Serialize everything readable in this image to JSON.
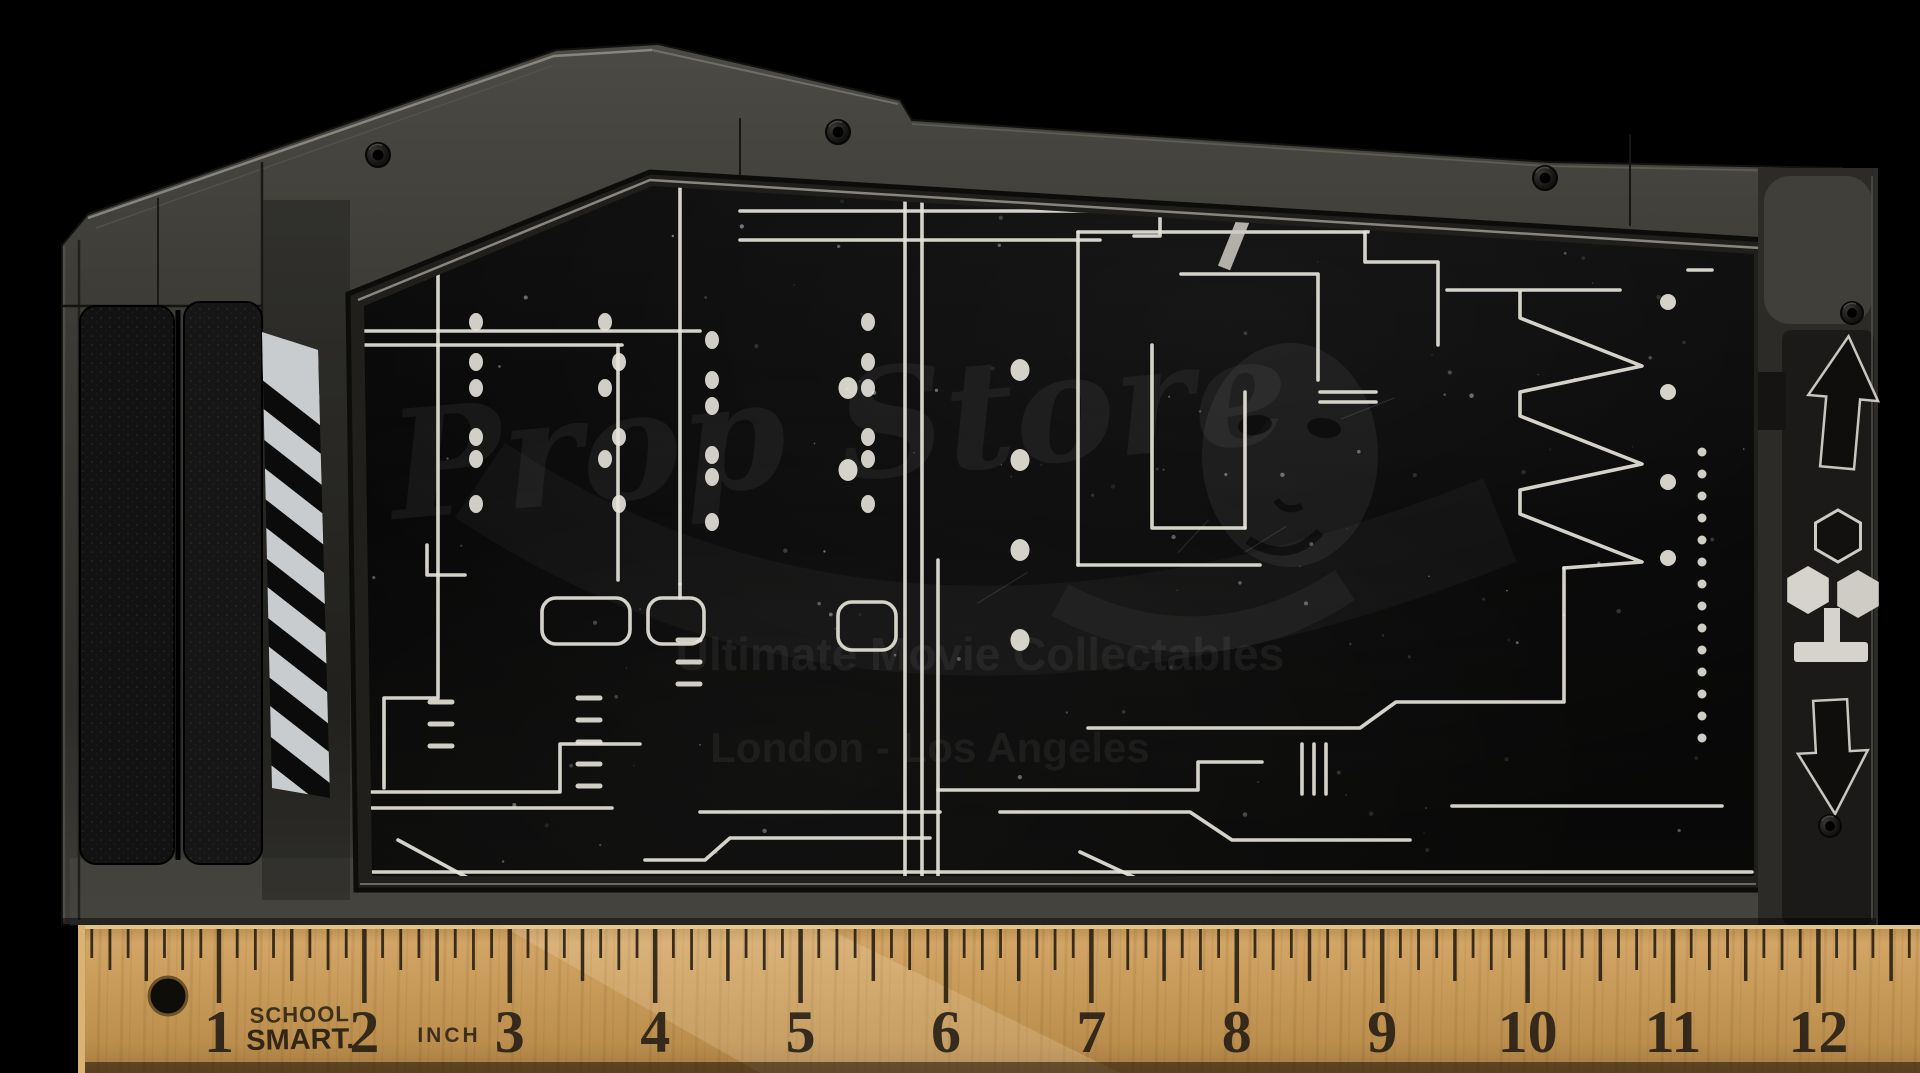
{
  "scene": {
    "background": "#000000",
    "description": "Sci-fi movie prop electronic panel with etched circuit screen, photographed above a wooden school ruler on black"
  },
  "watermark": {
    "script_text": "Prop Store",
    "line1": "Ultimate Movie Collectables",
    "line2": "London - Los Angeles",
    "mask_icon": "comedy-mask-icon",
    "color": "#ffffff"
  },
  "prop": {
    "body_color": "#3b3a36",
    "panel_color": "#2c2b28",
    "screen_color": "#060606",
    "trace_color": "#e6e3da",
    "grip": {
      "name": "leather-grip",
      "strips": 2,
      "color": "#121212"
    },
    "hazard_stripes": {
      "stripe_color": "#c9ccce",
      "gap_color": "#0b0b0b"
    },
    "icons": [
      {
        "name": "up-arrow-icon"
      },
      {
        "name": "hex-molecule-icon"
      },
      {
        "name": "down-arrow-icon"
      }
    ],
    "screws": [
      {
        "x": 378,
        "y": 155,
        "r": 12
      },
      {
        "x": 838,
        "y": 132,
        "r": 12
      },
      {
        "x": 1545,
        "y": 178,
        "r": 12
      },
      {
        "x": 1852,
        "y": 313,
        "r": 11
      },
      {
        "x": 1830,
        "y": 826,
        "r": 11
      }
    ],
    "traces": [
      "455,172 455,230 432,230 432,258",
      "352,249 480,249",
      "438,255 438,698 384,698 384,788",
      "352,331 700,331",
      "352,345 622,345",
      "520,160 662,160",
      "680,148 680,584",
      "618,345 618,580",
      "680,584 680,598",
      "427,545 427,575 465,575",
      "352,792 558,792",
      "352,808 612,808",
      "398,840 468,878",
      "468,878 648,878",
      "560,792 560,744 640,744",
      "905,150 905,878",
      "922,150 922,878",
      "938,560 938,878",
      "770,188 905,188",
      "740,211 1160,211 1160,236 1134,236",
      "740,240 1100,240",
      "1181,274 1318,274 1318,380",
      "1320,392 1376,392",
      "1320,402 1376,402",
      "938,790 1198,790 1198,762 1262,762",
      "1000,812 1190,812 1232,840 1410,840",
      "1452,806 1722,806",
      "1302,744 1302,794",
      "1314,744 1314,794",
      "1326,744 1326,794",
      "1080,852 1140,880",
      "1564,568 1564,702 1396,702 1360,728 1088,728",
      "1078,232 1365,232",
      "1078,232 1078,565",
      "1078,565 1260,565",
      "1368,168 1368,232",
      "1365,232 1365,262 1438,262 1438,345",
      "1152,345 1152,528 1245,528",
      "1245,392 1245,528",
      "1447,290 1620,290",
      "1688,270 1712,270",
      "1520,292 1520,318 1642,366 1520,392 1520,416 1642,464 1520,490 1520,514 1642,562 1564,568",
      "700,812 940,812",
      "645,860 705,860 730,838 930,838",
      "364,872 1752,872"
    ],
    "diagonal_trace": {
      "x1": 1253,
      "y1": 196,
      "x2": 1224,
      "y2": 268,
      "width": 13
    },
    "rounded_boxes": [
      [
        542,
        598,
        88,
        46
      ],
      [
        648,
        598,
        56,
        46
      ],
      [
        838,
        602,
        58,
        48
      ]
    ],
    "dashes": [
      [
        430,
        702
      ],
      [
        430,
        724
      ],
      [
        430,
        746
      ],
      [
        578,
        698
      ],
      [
        578,
        720
      ],
      [
        578,
        742
      ],
      [
        578,
        764
      ],
      [
        578,
        786
      ],
      [
        678,
        640
      ],
      [
        678,
        662
      ],
      [
        678,
        684
      ]
    ],
    "dot_columns": [
      {
        "x": 476,
        "ys": [
          322,
          362,
          388,
          437,
          459,
          504
        ]
      },
      {
        "x": 612,
        "ys": [
          322,
          362,
          388,
          437,
          459,
          504
        ],
        "stagger": 7
      },
      {
        "x": 712,
        "ys": [
          340,
          380,
          406,
          455,
          477,
          522
        ]
      },
      {
        "x": 868,
        "ys": [
          322,
          362,
          388,
          437,
          459,
          504
        ]
      }
    ],
    "big_dots": [
      [
        848,
        388
      ],
      [
        848,
        470
      ],
      [
        1020,
        370
      ],
      [
        1020,
        460
      ],
      [
        1020,
        550
      ],
      [
        1020,
        640
      ]
    ],
    "zig_dots": [
      [
        1668,
        302
      ],
      [
        1668,
        392
      ],
      [
        1668,
        482
      ],
      [
        1668,
        558
      ]
    ],
    "dotted_column": {
      "x": 1702,
      "y_start": 452,
      "step": 22,
      "count": 14
    }
  },
  "ruler": {
    "brand": [
      "SCHOOL",
      "SMART."
    ],
    "unit_label": "INCH",
    "numbers": [
      1,
      2,
      3,
      4,
      5,
      6,
      7,
      8,
      9,
      10,
      11,
      12
    ],
    "first_inch_x": 219,
    "pixels_per_inch": 145.4,
    "top_y": 925,
    "wood_color": "#c79a58",
    "ink_color": "#1d1812",
    "hole": {
      "x": 168,
      "y": 996,
      "r": 19
    }
  }
}
